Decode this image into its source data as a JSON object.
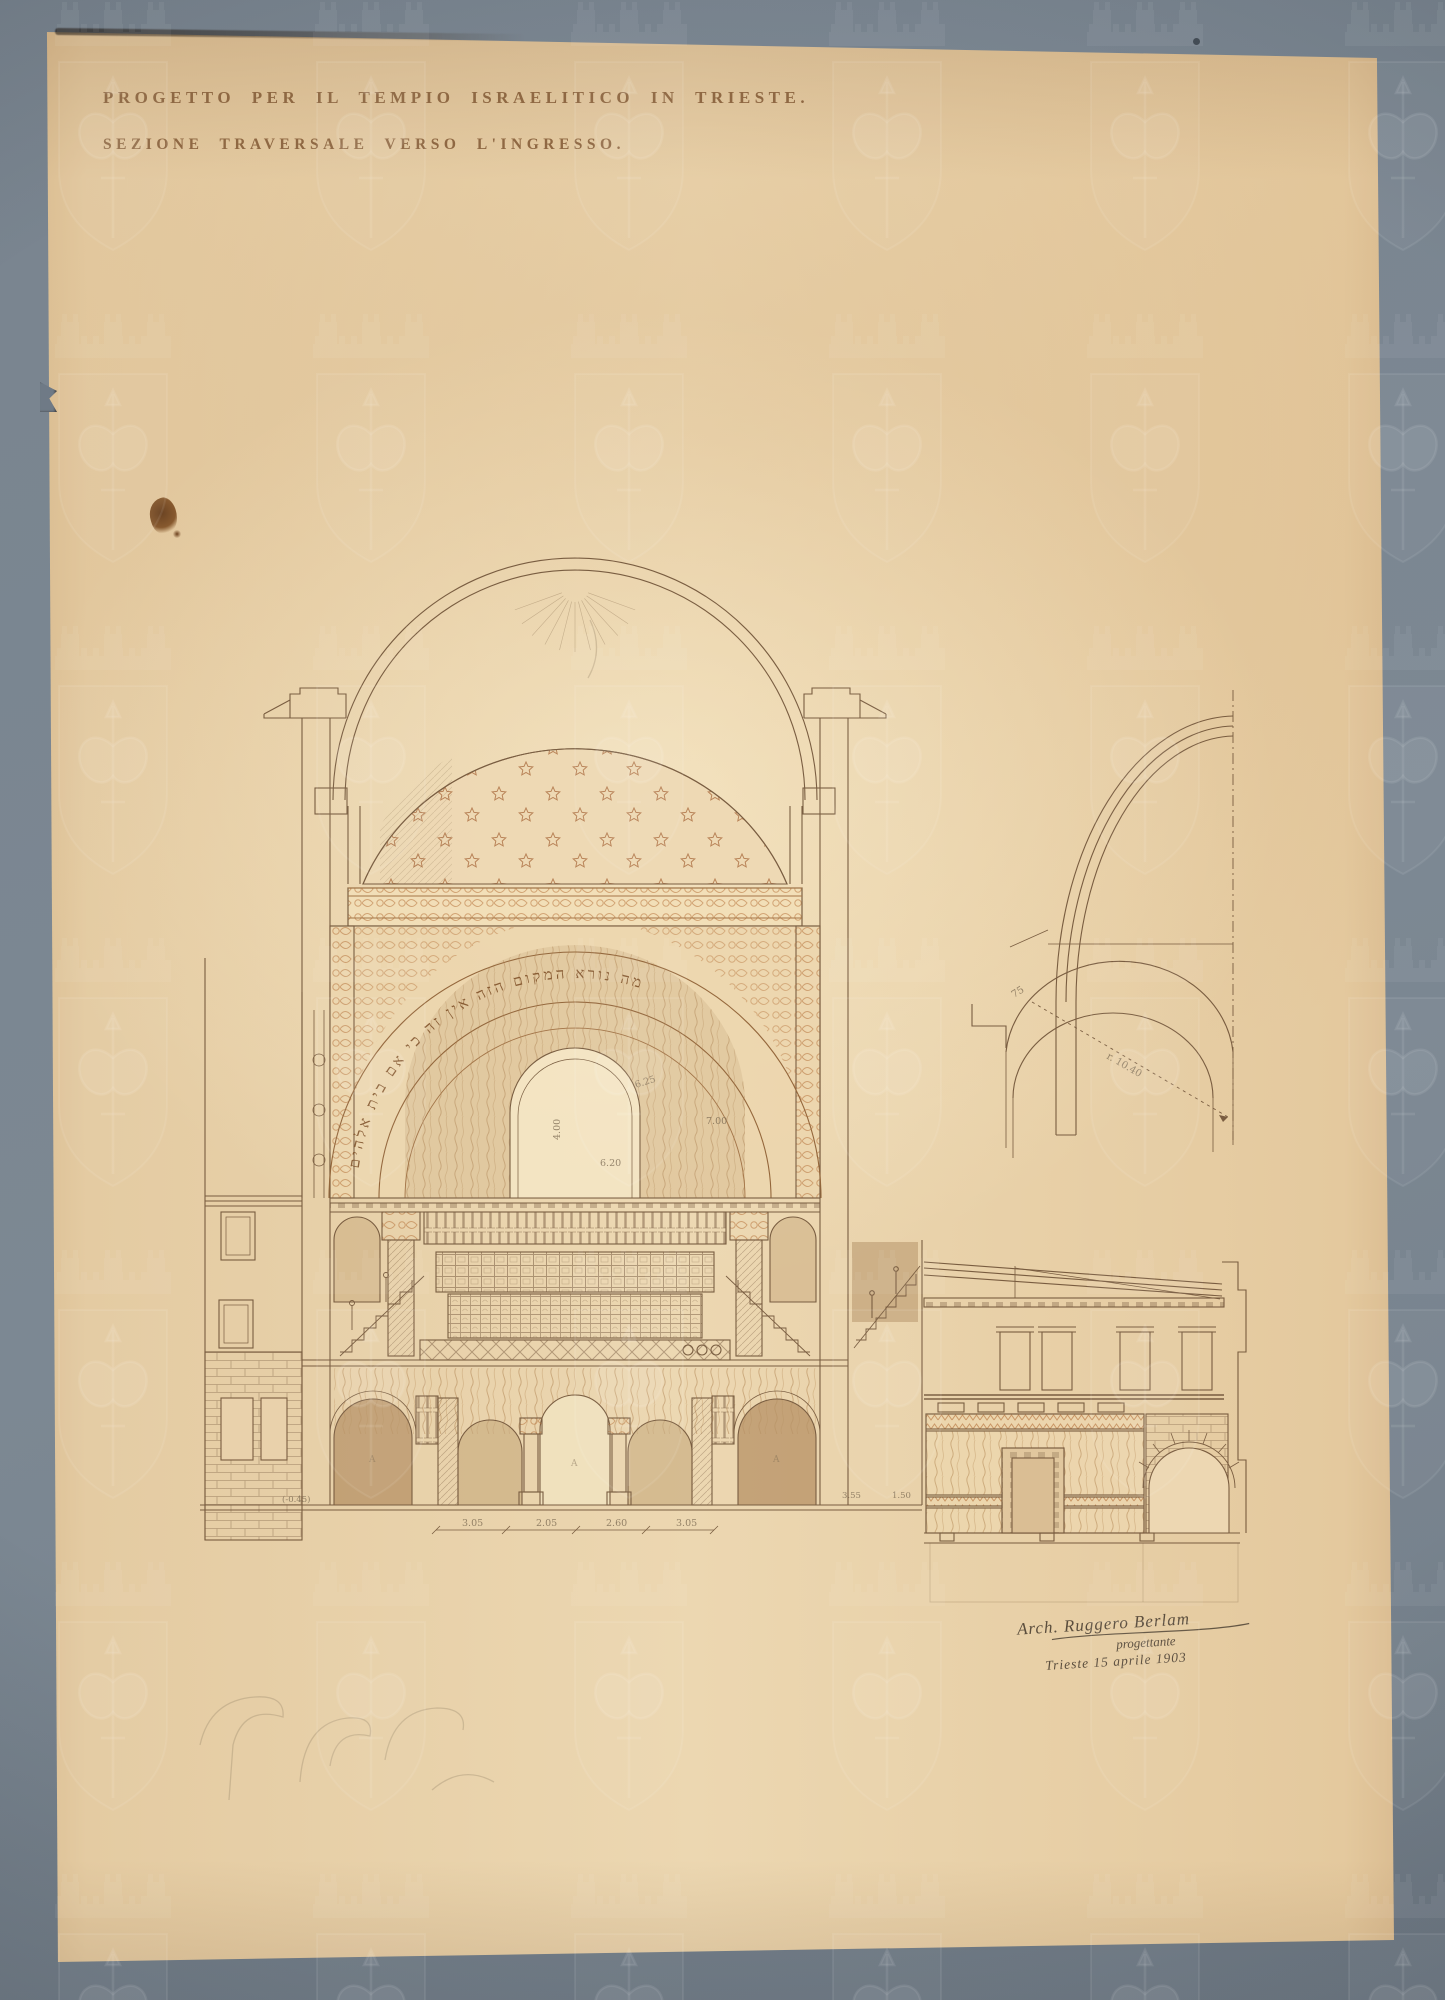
{
  "artwork": {
    "title_line1": "PROGETTO PER IL TEMPIO ISRAELITICO IN TRIESTE.",
    "title_line2": "SEZIONE TRAVERSALE VERSO L'INGRESSO.",
    "hebrew_inscription": "מה נורא המקום הזה אין זה כי אם בית אלהים",
    "signature_line1": "Arch. Ruggero Berlam",
    "signature_line2": "progettante",
    "signature_line3": "Trieste 15 aprile 1903",
    "annotations": {
      "detail_width": "75",
      "detail_radius": "r. 10.40",
      "win_a": "6.25",
      "win_b": "7.00",
      "win_c": "6.20",
      "win_d": "4.00",
      "dim_1": "3.05",
      "dim_2": "2.05",
      "dim_3": "2.60",
      "dim_4": "3.05",
      "dim_5": "3.55",
      "dim_6": "1.50",
      "base_level": "(-0.45)",
      "pier_mark": "A"
    },
    "colors": {
      "mount": "#7a8591",
      "paper": "#e8d0aa",
      "ink": "#6d5035",
      "ornament": "#b5713a"
    }
  }
}
